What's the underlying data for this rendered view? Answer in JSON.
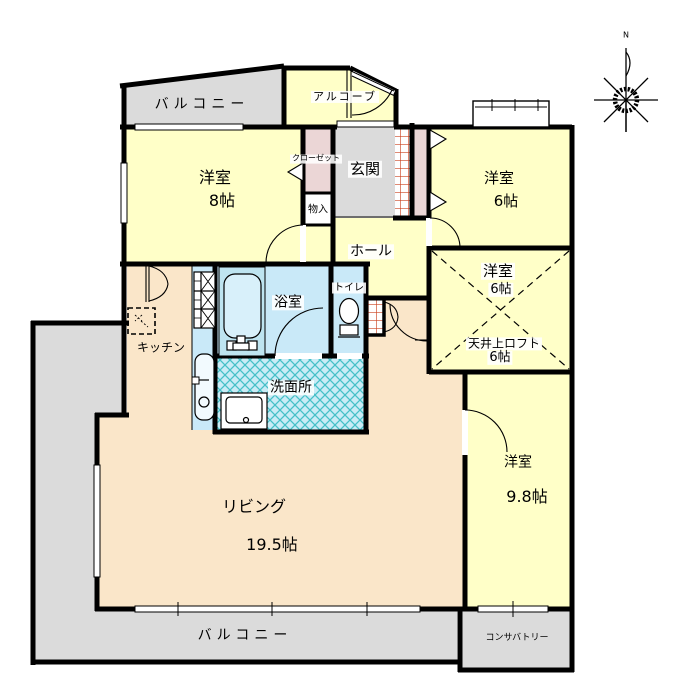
{
  "page": {
    "title": "間取り図 (floor plan)"
  },
  "colors": {
    "wall": "#000000",
    "room_yellow": "#FFFFC8",
    "balcony_gray": "#DBDBDB",
    "living_peach": "#FAE6C9",
    "wet_blue": "#C9E9F8",
    "tub_blue": "#BEE4F0",
    "closet_pink": "#EBD6D6",
    "hatch_teal": "#45C0C8",
    "hatch_red": "#CC4422"
  },
  "compass": {
    "north_label": "N"
  },
  "rooms": {
    "balcony_top": {
      "label": "バルコニー"
    },
    "alcove": {
      "label": "アルコーブ"
    },
    "room8": {
      "label": "洋室",
      "size": "8帖"
    },
    "closet": {
      "label": "クローゼット"
    },
    "storage": {
      "label": "物入"
    },
    "genkan": {
      "label": "玄関"
    },
    "room6_top": {
      "label": "洋室",
      "size": "6帖"
    },
    "hall": {
      "label": "ホール"
    },
    "room6_loft": {
      "label": "洋室",
      "size": "6帖",
      "loft_label": "天井上ロフト",
      "loft_size": "6帖"
    },
    "bathroom": {
      "label": "浴室"
    },
    "toilet": {
      "label": "トイレ"
    },
    "kitchen": {
      "label": "キッチン"
    },
    "washroom": {
      "label": "洗面所"
    },
    "living": {
      "label": "リビング",
      "size": "19.5帖"
    },
    "room98": {
      "label": "洋室",
      "size": "9.8帖"
    },
    "balcony_bottom": {
      "label": "バルコニー"
    },
    "conservatory": {
      "label": "コンサバトリー"
    }
  }
}
